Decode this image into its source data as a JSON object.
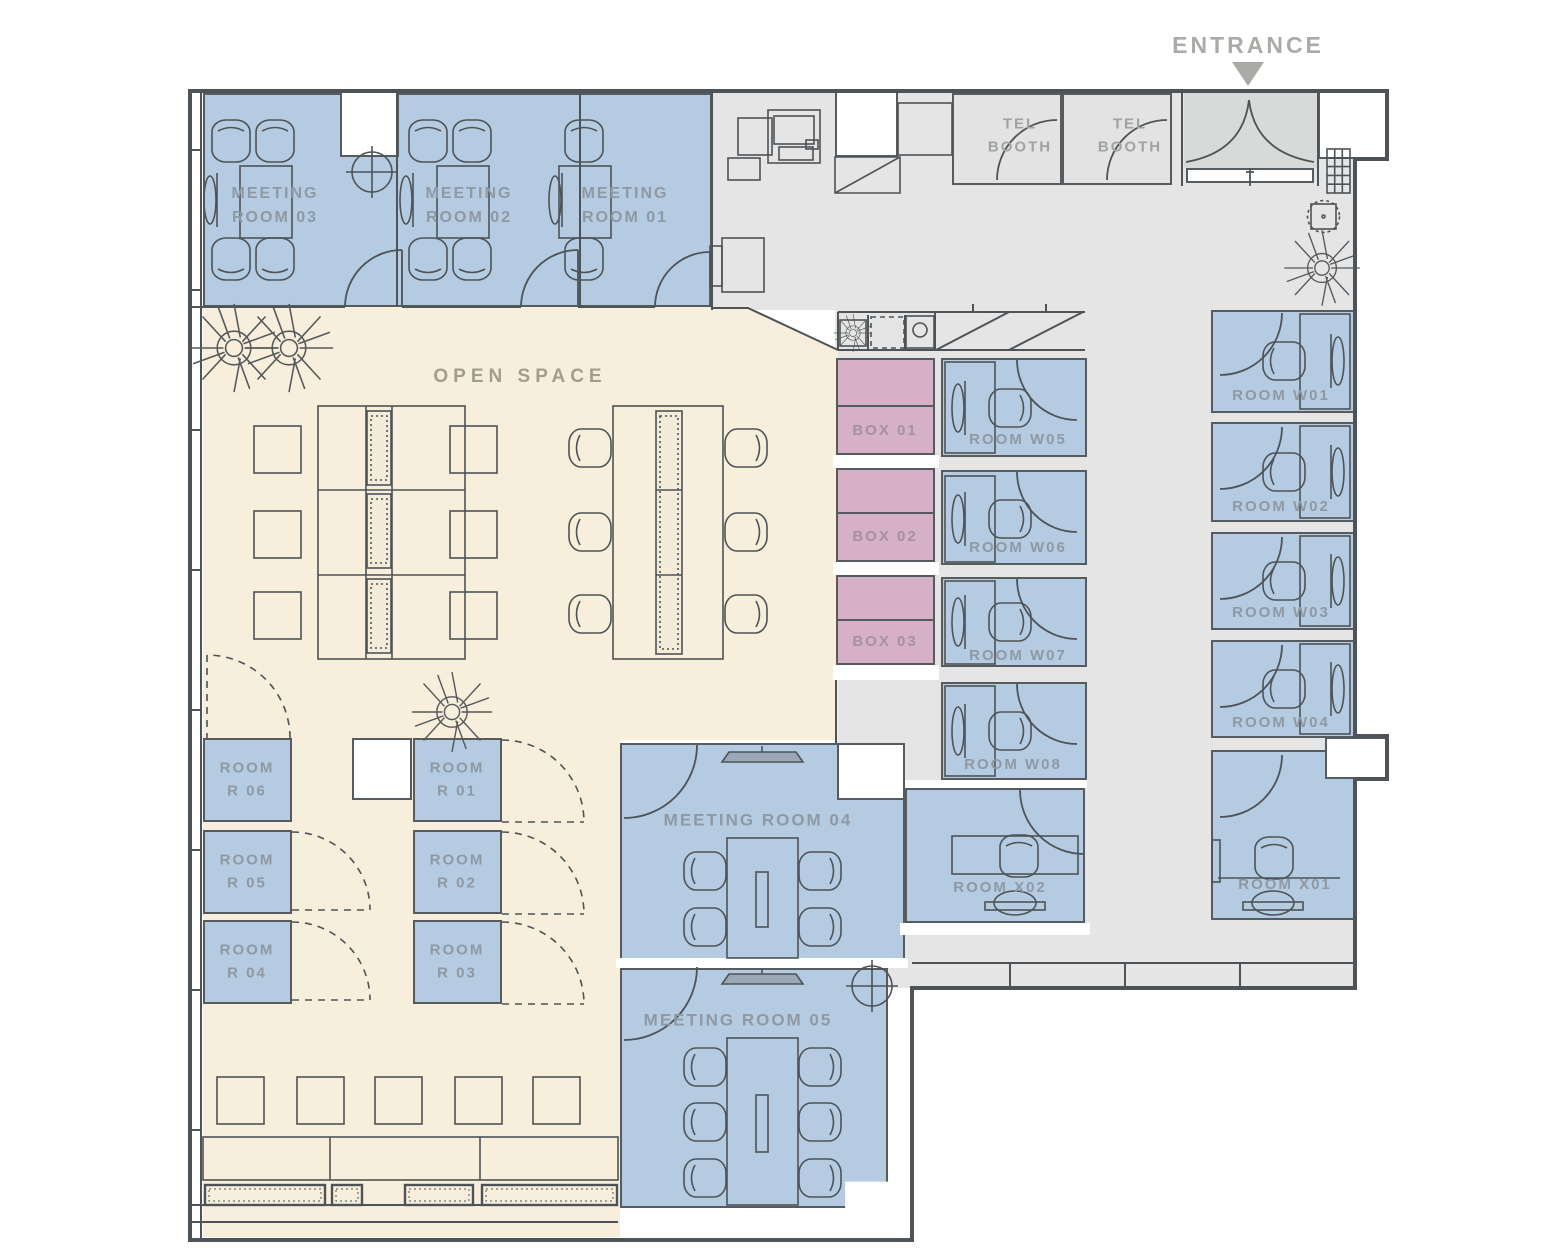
{
  "title": "Office Floor Plan",
  "entrance": {
    "label": "ENTRANCE"
  },
  "open_space": {
    "label": "OPEN SPACE"
  },
  "meeting_rooms": [
    {
      "id": "03",
      "label": "MEETING\nROOM 03"
    },
    {
      "id": "02",
      "label": "MEETING\nROOM 02"
    },
    {
      "id": "01",
      "label": "MEETING\nROOM 01"
    },
    {
      "id": "04",
      "label": "MEETING ROOM 04"
    },
    {
      "id": "05",
      "label": "MEETING ROOM 05"
    }
  ],
  "tel_booths": [
    {
      "label": "TEL\nBOOTH"
    },
    {
      "label": "TEL\nBOOTH"
    }
  ],
  "boxes": [
    {
      "label": "BOX 01"
    },
    {
      "label": "BOX 02"
    },
    {
      "label": "BOX 03"
    }
  ],
  "w_rooms": [
    {
      "label": "ROOM W01"
    },
    {
      "label": "ROOM W02"
    },
    {
      "label": "ROOM W03"
    },
    {
      "label": "ROOM W04"
    },
    {
      "label": "ROOM W05"
    },
    {
      "label": "ROOM W06"
    },
    {
      "label": "ROOM W07"
    },
    {
      "label": "ROOM W08"
    }
  ],
  "x_rooms": [
    {
      "label": "ROOM X01"
    },
    {
      "label": "ROOM X02"
    }
  ],
  "r_rooms": [
    {
      "label": "ROOM\nR 01"
    },
    {
      "label": "ROOM\nR 02"
    },
    {
      "label": "ROOM\nR 03"
    },
    {
      "label": "ROOM\nR 04"
    },
    {
      "label": "ROOM\nR 05"
    },
    {
      "label": "ROOM\nR 06"
    }
  ],
  "colors": {
    "room_blue": "#b4cbe2",
    "box_pink": "#d6b0c7",
    "open_space_beige": "#f7efdc",
    "corridor_gray": "#e4e5e4",
    "vestibule_gray": "#d8dad9",
    "wall": "#4e5357",
    "label_blue_room": "#8f99a4",
    "label_beige": "#a49d8c",
    "label_entrance": "#a9aca6"
  }
}
